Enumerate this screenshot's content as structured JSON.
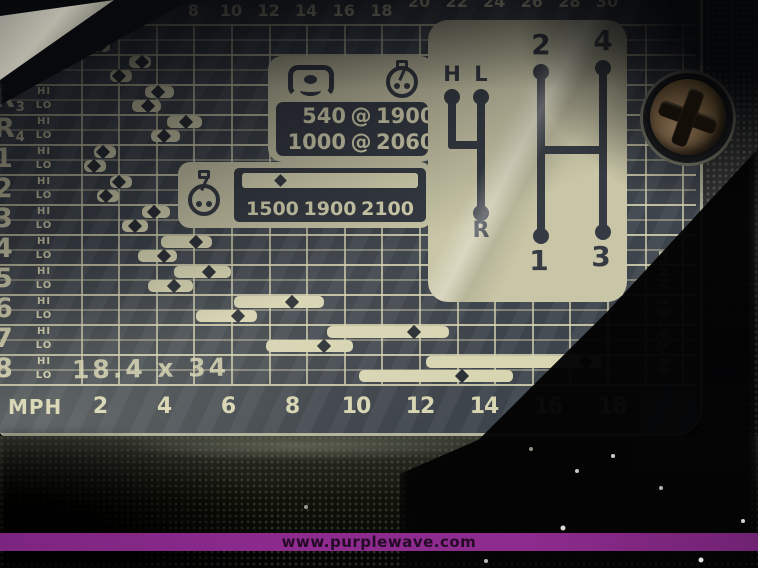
{
  "photo": {
    "watermark_text": "www.purplewave.com",
    "stripe_color": "#8e2b8e"
  },
  "decal": {
    "part_number": "EINN-7B292-FA",
    "tire_size": "18.4 x 34",
    "colors": {
      "ink": "#d8d5b3",
      "panel_dark": "#363b43",
      "box_bg": "#c9c6a7",
      "decal_base": "#41474e"
    },
    "pto_box": {
      "icons": [
        "pto-icon",
        "tach-icon"
      ],
      "rows": [
        [
          "540",
          "@",
          "1900"
        ],
        [
          "1000",
          "@",
          "2060"
        ]
      ]
    },
    "rpm_box": {
      "icon": "tach-icon",
      "values": [
        "1500",
        "1900",
        "2100"
      ]
    },
    "shift_pattern": {
      "range_lever": {
        "top_left": "H",
        "top_right": "L",
        "bottom": "R"
      },
      "gear_lever": {
        "top_left": "2",
        "top_right": "4",
        "bottom_left": "1",
        "bottom_right": "3"
      }
    }
  },
  "chart_data": {
    "type": "bar",
    "title": "Tractor ground-speed chart: speed range bars per gear (HI/LO)",
    "top_axis": {
      "unit": "km/h",
      "ticks": [
        4,
        6,
        8,
        10,
        12,
        14,
        16,
        18,
        20,
        22,
        24,
        26,
        28,
        30
      ]
    },
    "bottom_axis": {
      "unit": "MPH",
      "label": "MPH",
      "ticks": [
        2,
        4,
        6,
        8,
        10,
        12,
        14,
        16,
        18
      ]
    },
    "row_sublabels": [
      "HI",
      "LO"
    ],
    "marker_meaning": "diamond = speed at 1900 rpm; bar spans 1500-2100 rpm",
    "rows": [
      {
        "gear": "R1",
        "hi": {
          "range": [
            1.8,
            2.5
          ],
          "marker": 2.2
        },
        "lo": {
          "range": [
            1.7,
            2.3
          ],
          "marker": 2.0
        }
      },
      {
        "gear": "R2",
        "hi": {
          "range": [
            2.9,
            3.6
          ],
          "marker": 3.3
        },
        "lo": {
          "range": [
            2.3,
            3.0
          ],
          "marker": 2.6
        }
      },
      {
        "gear": "R3",
        "hi": {
          "range": [
            3.4,
            4.3
          ],
          "marker": 3.8
        },
        "lo": {
          "range": [
            3.0,
            3.9
          ],
          "marker": 3.5
        }
      },
      {
        "gear": "R4",
        "hi": {
          "range": [
            4.1,
            5.2
          ],
          "marker": 4.7
        },
        "lo": {
          "range": [
            3.6,
            4.5
          ],
          "marker": 4.0
        }
      },
      {
        "gear": "1",
        "hi": {
          "range": [
            1.8,
            2.5
          ],
          "marker": 2.1
        },
        "lo": {
          "range": [
            1.5,
            2.2
          ],
          "marker": 1.8
        }
      },
      {
        "gear": "2",
        "hi": {
          "range": [
            2.3,
            3.0
          ],
          "marker": 2.6
        },
        "lo": {
          "range": [
            1.9,
            2.6
          ],
          "marker": 2.2
        }
      },
      {
        "gear": "3",
        "hi": {
          "range": [
            3.3,
            4.2
          ],
          "marker": 3.7
        },
        "lo": {
          "range": [
            2.7,
            3.5
          ],
          "marker": 3.1
        }
      },
      {
        "gear": "4",
        "hi": {
          "range": [
            3.9,
            5.5
          ],
          "marker": 5.0
        },
        "lo": {
          "range": [
            3.2,
            4.4
          ],
          "marker": 4.0
        }
      },
      {
        "gear": "5",
        "hi": {
          "range": [
            4.3,
            6.1
          ],
          "marker": 5.4
        },
        "lo": {
          "range": [
            3.5,
            4.9
          ],
          "marker": 4.3
        }
      },
      {
        "gear": "6",
        "hi": {
          "range": [
            6.2,
            9.0
          ],
          "marker": 8.0
        },
        "lo": {
          "range": [
            5.0,
            6.9
          ],
          "marker": 6.3
        }
      },
      {
        "gear": "7",
        "hi": {
          "range": [
            9.1,
            12.9
          ],
          "marker": 11.8
        },
        "lo": {
          "range": [
            7.2,
            9.9
          ],
          "marker": 9.0
        }
      },
      {
        "gear": "8",
        "hi": {
          "range": [
            12.2,
            17.7
          ],
          "marker": 17.2
        },
        "lo": {
          "range": [
            10.1,
            14.9
          ],
          "marker": 13.3
        }
      }
    ]
  }
}
